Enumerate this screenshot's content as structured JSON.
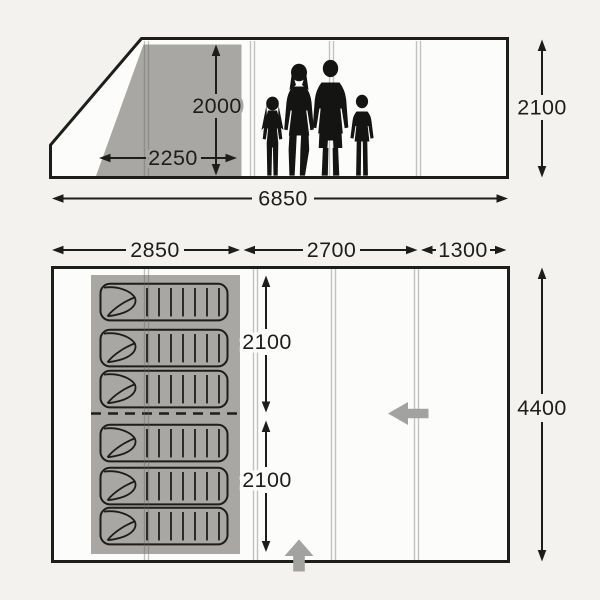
{
  "diagram": {
    "title": "Tent dimensions diagram",
    "side_view": {
      "labels": {
        "bedroom_height": "2000",
        "bedroom_depth": "2250",
        "total_length": "6850",
        "overall_height": "2100"
      }
    },
    "floor_plan": {
      "labels": {
        "bedroom_section_width": "2850",
        "living_section_width": "2700",
        "front_section_width": "1300",
        "bedroom_top_length": "2100",
        "bedroom_bottom_length": "2100",
        "overall_depth": "4400"
      }
    },
    "colors": {
      "outline": "#1d1d1b",
      "bedroom_fill": "#a8a7a4",
      "entrance_arrow": "#a2a2a0",
      "background": "#f3f2ef",
      "silhouette": "#141413"
    }
  }
}
